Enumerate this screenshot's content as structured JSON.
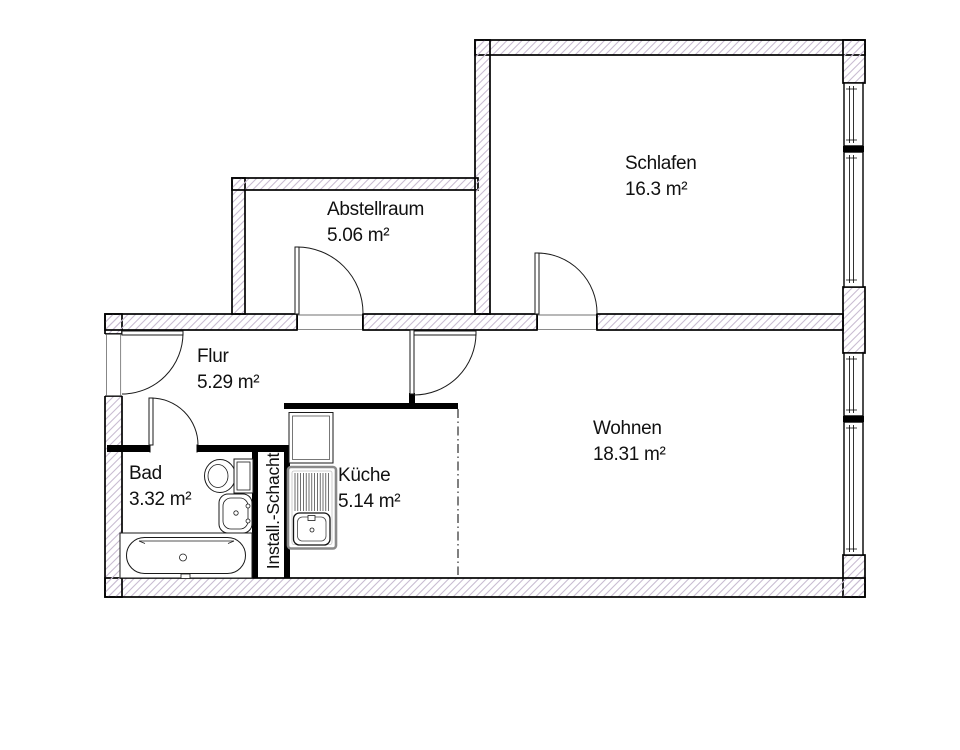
{
  "plan": {
    "rooms": [
      {
        "name": "Schlafen",
        "area": "16.3 m²"
      },
      {
        "name": "Abstellraum",
        "area": "5.06 m²"
      },
      {
        "name": "Flur",
        "area": "5.29 m²"
      },
      {
        "name": "Bad",
        "area": "3.32 m²"
      },
      {
        "name": "Küche",
        "area": "5.14 m²"
      },
      {
        "name": "Wohnen",
        "area": "18.31 m²"
      }
    ],
    "shaft_label": "Install.-Schacht",
    "colors": {
      "wall_hatch": "#c9bdd2",
      "line": "#000000",
      "background": "#ffffff",
      "counter_gray": "#8a8a8a"
    }
  }
}
